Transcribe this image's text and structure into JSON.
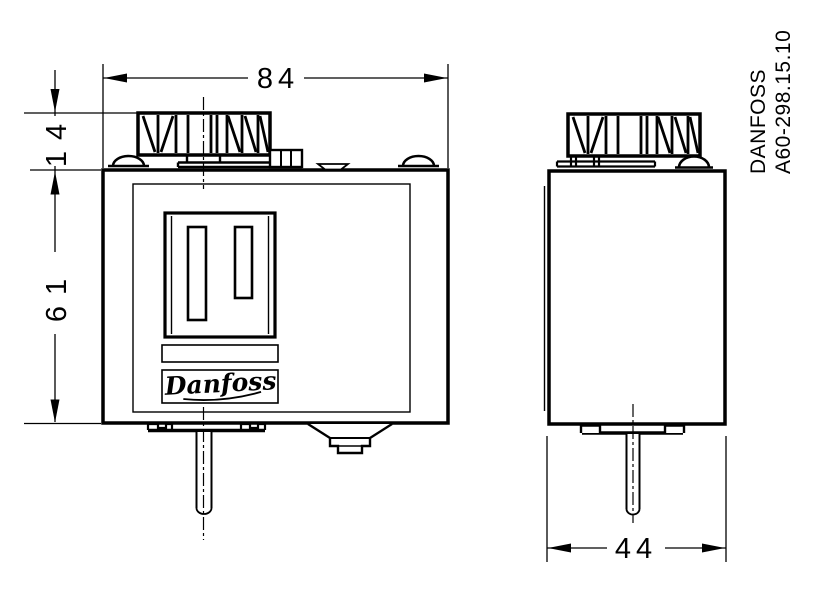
{
  "drawing": {
    "background": "#ffffff",
    "line_color": "#000000"
  },
  "dimensions": {
    "overall_width": "84",
    "knob_height": "14",
    "body_height": "61",
    "body_depth": "44"
  },
  "reference": {
    "line1": "DANFOSS",
    "line2": "A60-298.15.10"
  },
  "logo": {
    "text": "Danfoss"
  }
}
